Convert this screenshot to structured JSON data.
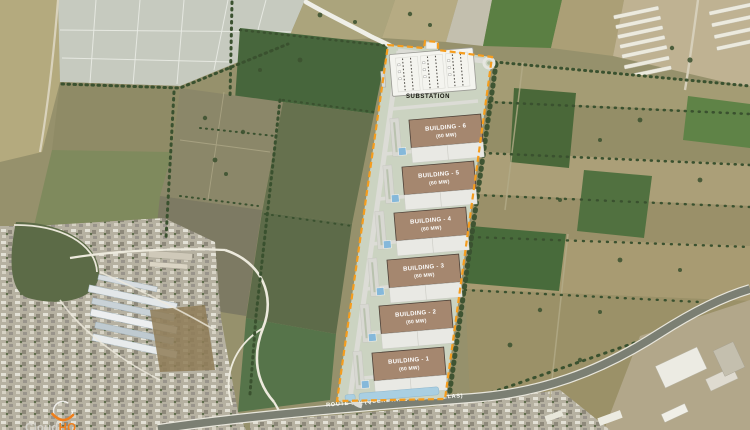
{
  "map": {
    "watermark": {
      "brand": "CloudHQ",
      "brand_gray": "Cloud",
      "brand_accent": "HQ"
    },
    "highway": {
      "label": "ROUTE 100 (QUERETARO - HIGUERILLAS)"
    },
    "site": {
      "substation_label": "SUBSTATION",
      "buildings": [
        {
          "name": "BUILDING - 6",
          "capacity": "(60 MW)"
        },
        {
          "name": "BUILDING - 5",
          "capacity": "(60 MW)"
        },
        {
          "name": "BUILDING - 4",
          "capacity": "(60 MW)"
        },
        {
          "name": "BUILDING - 3",
          "capacity": "(60 MW)"
        },
        {
          "name": "BUILDING - 2",
          "capacity": "(60 MW)"
        },
        {
          "name": "BUILDING - 1",
          "capacity": "(60 MW)"
        }
      ]
    },
    "colors": {
      "boundary": "#F59D1E",
      "building_fill": "#A5876F",
      "site_fill": "#CBD3C1",
      "water": "#85B8DA",
      "accent": "#EF7F1C"
    }
  }
}
